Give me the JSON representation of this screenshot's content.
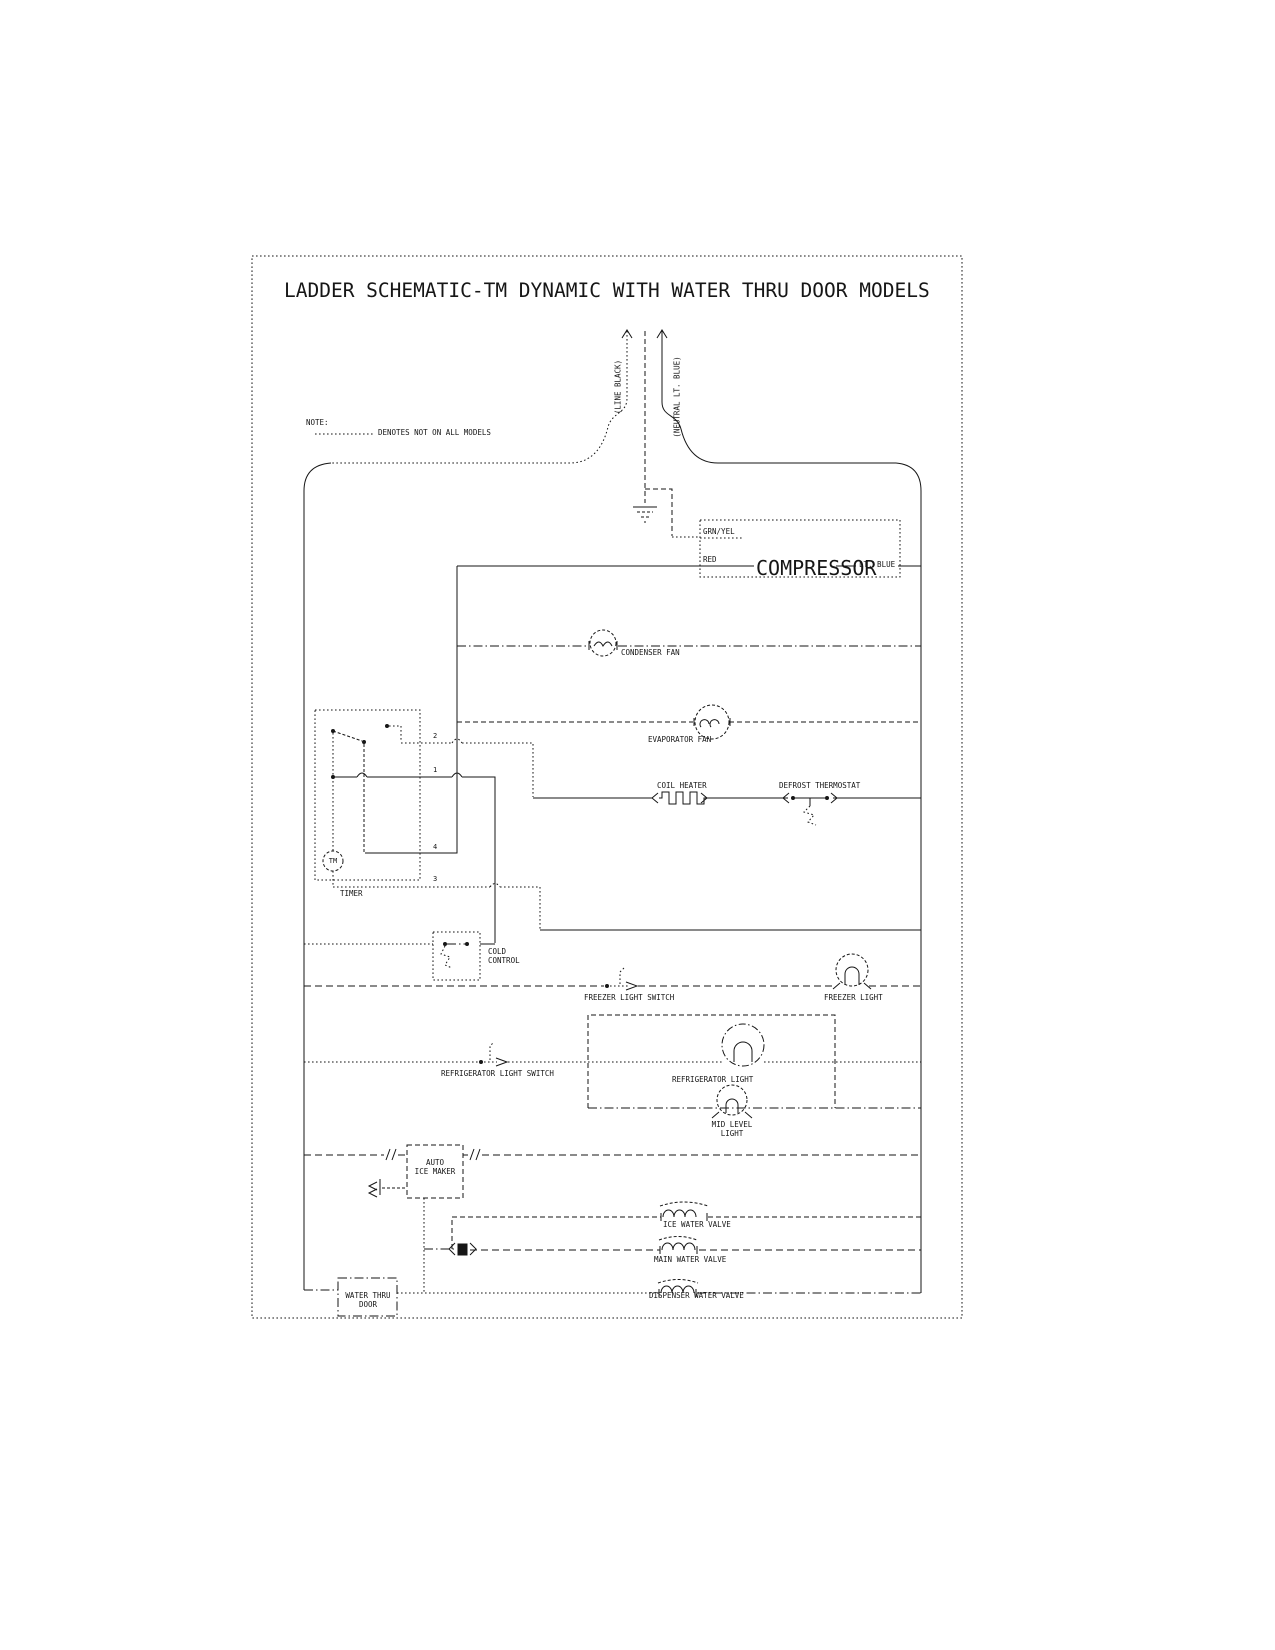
{
  "title": "LADDER SCHEMATIC-TM DYNAMIC WITH WATER THRU DOOR MODELS",
  "note": {
    "heading": "NOTE:",
    "legend": "DENOTES NOT ON ALL MODELS"
  },
  "supply": {
    "line_label": "(LINE BLACK)",
    "neutral_label": "(NEUTRAL LT. BLUE)"
  },
  "compressor": {
    "label": "COMPRESSOR",
    "ground_wire": "GRN/YEL",
    "line_wire": "RED",
    "neutral_wire": "LT. BLUE"
  },
  "timer": {
    "label": "TIMER",
    "motor": "TM",
    "terminals": {
      "t2": "2",
      "t1": "1",
      "t4": "4",
      "t3": "3"
    }
  },
  "labels": {
    "condenser_fan": "CONDENSER FAN",
    "evaporator_fan": "EVAPORATOR FAN",
    "coil_heater": "COIL HEATER",
    "defrost_thermostat": "DEFROST THERMOSTAT",
    "cold_control": "COLD\nCONTROL",
    "freezer_light_switch": "FREEZER LIGHT SWITCH",
    "freezer_light": "FREEZER LIGHT",
    "refrigerator_light_switch": "REFRIGERATOR LIGHT SWITCH",
    "refrigerator_light": "REFRIGERATOR LIGHT",
    "mid_level_light": "MID LEVEL\nLIGHT",
    "auto_ice_maker": "AUTO\nICE MAKER",
    "ice_water_valve": "ICE WATER VALVE",
    "main_water_valve": "MAIN WATER VALVE",
    "dispenser_water_valve": "DISPENSER WATER VALVE",
    "water_thru_door": "WATER THRU\nDOOR"
  },
  "colors": {
    "ink": "#161616",
    "paper": "#ffffff"
  }
}
